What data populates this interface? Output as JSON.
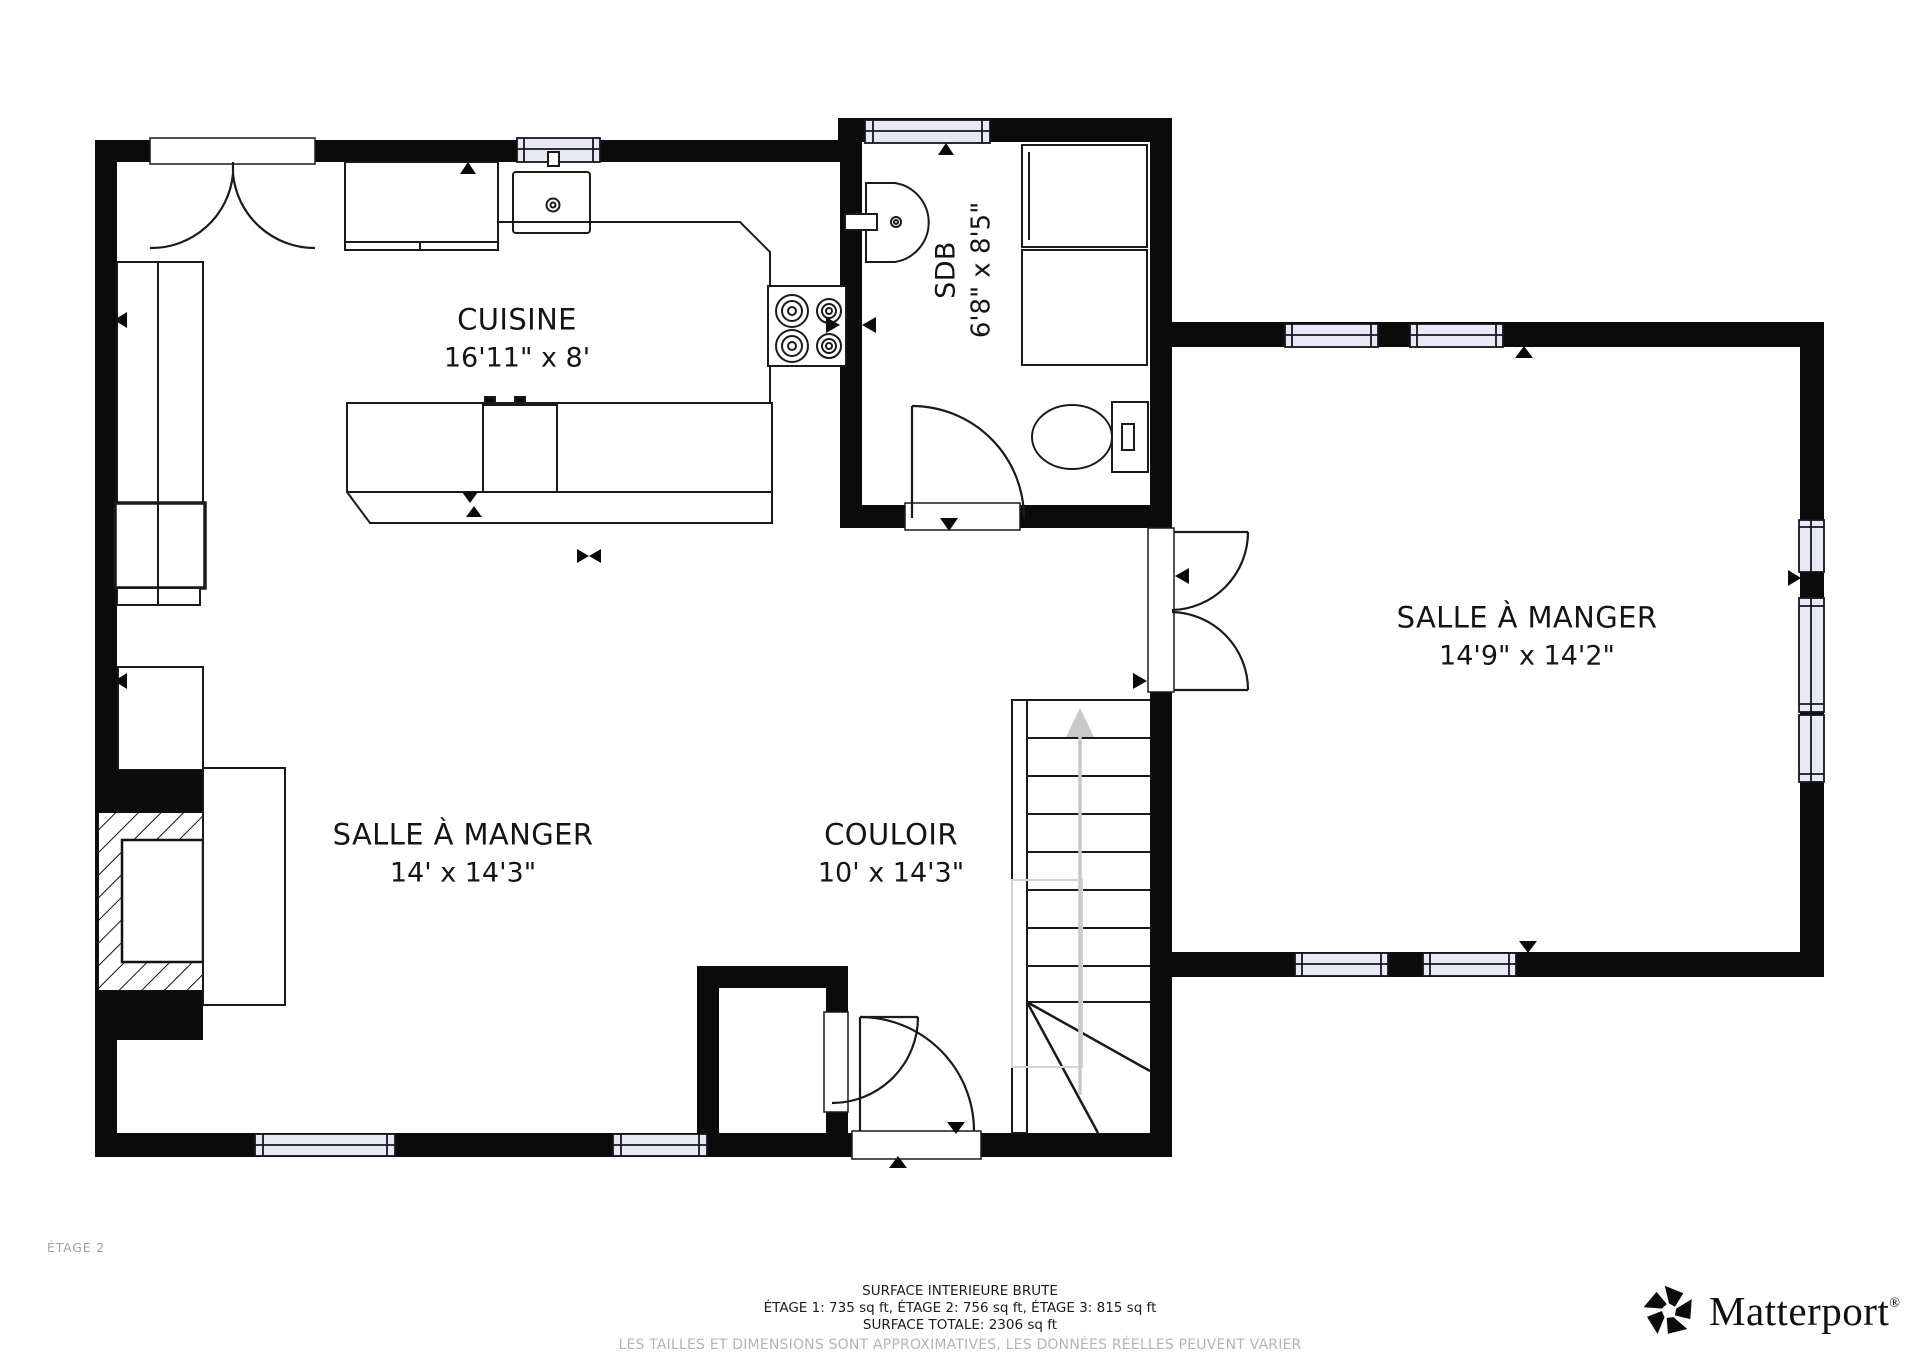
{
  "floorplan": {
    "floor_label": "ÉTAGE 2",
    "rooms": {
      "cuisine": {
        "name": "CUISINE",
        "dims": "16'11\" x 8'"
      },
      "sdb": {
        "name": "SDB",
        "dims": "6'8\" x 8'5\""
      },
      "salle_droite": {
        "name": "SALLE À MANGER",
        "dims": "14'9\" x 14'2\""
      },
      "salle_gauche": {
        "name": "SALLE À MANGER",
        "dims": "14' x 14'3\""
      },
      "couloir": {
        "name": "COULOIR",
        "dims": "10' x 14'3\""
      }
    },
    "fixtures": [
      "entry-double-door-icon",
      "kitchen-sink-icon",
      "stove-icon",
      "kitchen-island-icon",
      "dishwasher-icon",
      "bathroom-sink-icon",
      "shower-icon",
      "toilet-icon",
      "interior-door-icon",
      "double-door-icon",
      "stairs-up-icon",
      "fireplace-icon",
      "window-icon",
      "cabinet-icon",
      "armchair-icon"
    ],
    "colors": {
      "wall": "#0b0b0b",
      "line": "#1a1a1a",
      "window": "#e9e9f6",
      "stair_arrow": "#c9c9c9",
      "muted": "#a3a3a3",
      "disclaimer": "#b4b4b4"
    }
  },
  "footer": {
    "title": "SURFACE INTERIEURE BRUTE",
    "areas": "ÉTAGE 1: 735 sq ft, ÉTAGE 2: 756 sq ft, ÉTAGE 3: 815 sq ft",
    "total": "SURFACE TOTALE: 2306 sq ft",
    "disclaimer": "LES TAILLES ET DIMENSIONS SONT APPROXIMATIVES, LES DONNÉES RÉELLES PEUVENT VARIER"
  },
  "brand": {
    "name": "Matterport",
    "registered_mark": "®"
  }
}
